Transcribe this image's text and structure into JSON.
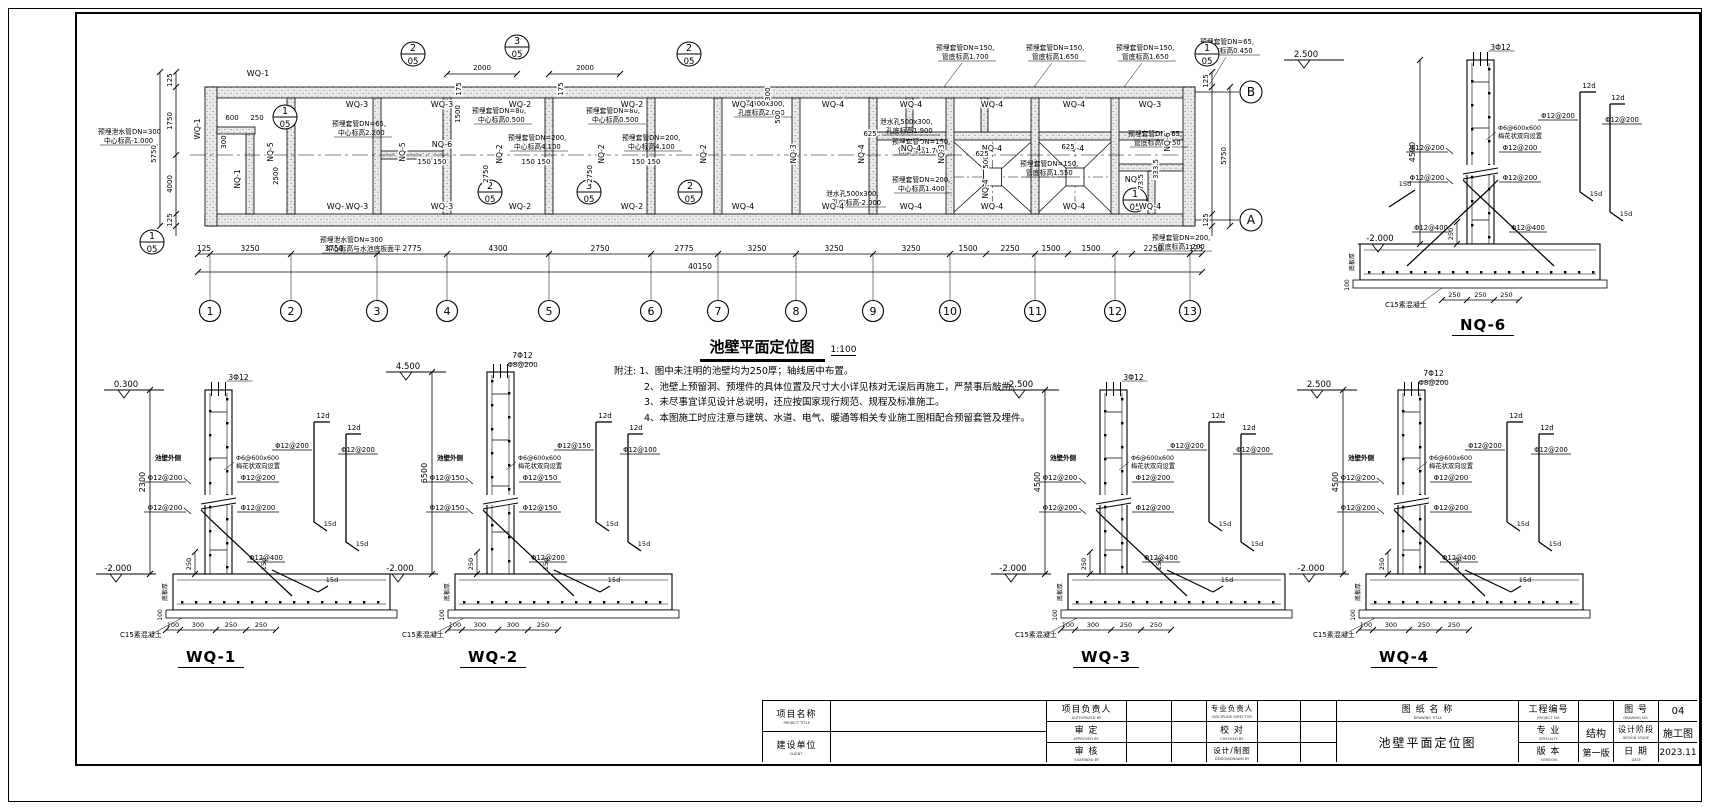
{
  "plan": {
    "title": "池壁平面定位图",
    "scale": "1:100",
    "grid_numbers": [
      "1",
      "2",
      "3",
      "4",
      "5",
      "6",
      "7",
      "8",
      "9",
      "10",
      "11",
      "12",
      "13"
    ],
    "axis_letters": {
      "top": "B",
      "bottom": "A"
    },
    "total_dim": "40150",
    "bottom_dims": [
      {
        "t": "125",
        "x": 124
      },
      {
        "t": "3250",
        "x": 170
      },
      {
        "t": "3750",
        "x": 254
      },
      {
        "t": "2775",
        "x": 332
      },
      {
        "t": "4300",
        "x": 418
      },
      {
        "t": "2750",
        "x": 520
      },
      {
        "t": "2775",
        "x": 604
      },
      {
        "t": "3250",
        "x": 677
      },
      {
        "t": "3250",
        "x": 754
      },
      {
        "t": "3250",
        "x": 831
      },
      {
        "t": "1500",
        "x": 888
      },
      {
        "t": "2250",
        "x": 930
      },
      {
        "t": "1500",
        "x": 971
      },
      {
        "t": "1500",
        "x": 1011
      },
      {
        "t": "2250",
        "x": 1073
      },
      {
        "t": "125",
        "x": 1116
      }
    ],
    "dims": [
      {
        "t": "125",
        "x": 92,
        "y": 66,
        "r": 1
      },
      {
        "t": "1750",
        "x": 92,
        "y": 107,
        "r": 1
      },
      {
        "t": "4000",
        "x": 92,
        "y": 170,
        "r": 1
      },
      {
        "t": "125",
        "x": 92,
        "y": 206,
        "r": 1
      },
      {
        "t": "5750",
        "x": 76,
        "y": 140,
        "r": 1
      },
      {
        "t": "600",
        "x": 152,
        "y": 106
      },
      {
        "t": "250",
        "x": 177,
        "y": 106
      },
      {
        "t": "300",
        "x": 146,
        "y": 128,
        "r": 1
      },
      {
        "t": "2500",
        "x": 198,
        "y": 162,
        "r": 1
      },
      {
        "t": "1500",
        "x": 380,
        "y": 100,
        "r": 1
      },
      {
        "t": "2750",
        "x": 408,
        "y": 160,
        "r": 1
      },
      {
        "t": "2750",
        "x": 512,
        "y": 160,
        "r": 1
      },
      {
        "t": "175",
        "x": 381,
        "y": 75,
        "r": 1
      },
      {
        "t": "175",
        "x": 483,
        "y": 75,
        "r": 1
      },
      {
        "t": "150  150",
        "x": 352,
        "y": 150
      },
      {
        "t": "150  150",
        "x": 456,
        "y": 150
      },
      {
        "t": "150  150",
        "x": 566,
        "y": 150
      },
      {
        "t": "2000",
        "x": 402,
        "y": 56
      },
      {
        "t": "2000",
        "x": 505,
        "y": 56
      },
      {
        "t": "300",
        "x": 690,
        "y": 80,
        "r": 1
      },
      {
        "t": "500",
        "x": 700,
        "y": 103,
        "r": 1
      },
      {
        "t": "500",
        "x": 908,
        "y": 148,
        "r": 1
      },
      {
        "t": "625",
        "x": 790,
        "y": 122
      },
      {
        "t": "625",
        "x": 902,
        "y": 142
      },
      {
        "t": "625",
        "x": 988,
        "y": 135
      },
      {
        "t": "333.5",
        "x": 1078,
        "y": 155,
        "r": 1
      },
      {
        "t": "73.5",
        "x": 1063,
        "y": 168,
        "r": 1
      },
      {
        "t": "125",
        "x": 1128,
        "y": 67,
        "r": 1
      },
      {
        "t": "125",
        "x": 1128,
        "y": 206,
        "r": 1
      },
      {
        "t": "5750",
        "x": 1146,
        "y": 142,
        "r": 1
      }
    ],
    "wall_labels": [
      {
        "t": "WQ-1",
        "x": 178,
        "y": 62
      },
      {
        "t": "WQ-3",
        "x": 277,
        "y": 93
      },
      {
        "t": "WQ-3",
        "x": 362,
        "y": 93
      },
      {
        "t": "WQ-2",
        "x": 440,
        "y": 93
      },
      {
        "t": "WQ-2",
        "x": 552,
        "y": 93
      },
      {
        "t": "WQ-4",
        "x": 663,
        "y": 93
      },
      {
        "t": "WQ-4",
        "x": 753,
        "y": 93
      },
      {
        "t": "WQ-4",
        "x": 831,
        "y": 93
      },
      {
        "t": "WQ-4",
        "x": 912,
        "y": 93
      },
      {
        "t": "WQ-4",
        "x": 994,
        "y": 93
      },
      {
        "t": "WQ-3",
        "x": 1070,
        "y": 93
      },
      {
        "t": "WQ-1",
        "x": 258,
        "y": 195
      },
      {
        "t": "WQ-3",
        "x": 277,
        "y": 195
      },
      {
        "t": "WQ-3",
        "x": 362,
        "y": 195
      },
      {
        "t": "WQ-2",
        "x": 440,
        "y": 195
      },
      {
        "t": "WQ-2",
        "x": 552,
        "y": 195
      },
      {
        "t": "WQ-4",
        "x": 663,
        "y": 195
      },
      {
        "t": "WQ-4",
        "x": 753,
        "y": 195
      },
      {
        "t": "WQ-4",
        "x": 831,
        "y": 195
      },
      {
        "t": "WQ-4",
        "x": 912,
        "y": 195
      },
      {
        "t": "WQ-4",
        "x": 994,
        "y": 195
      },
      {
        "t": "WQ-4",
        "x": 1070,
        "y": 195
      },
      {
        "t": "NQ-4",
        "x": 831,
        "y": 137
      },
      {
        "t": "NQ-4",
        "x": 912,
        "y": 137
      },
      {
        "t": "NQ-4",
        "x": 994,
        "y": 137
      },
      {
        "t": "NQ-6",
        "x": 362,
        "y": 133
      },
      {
        "t": "NQ-6",
        "x": 1055,
        "y": 168
      }
    ],
    "vlabels": [
      {
        "t": "WQ-1",
        "x": 120,
        "y": 115
      },
      {
        "t": "NQ-1",
        "x": 160,
        "y": 165
      },
      {
        "t": "NQ-5",
        "x": 193,
        "y": 138
      },
      {
        "t": "NQ-5",
        "x": 325,
        "y": 138
      },
      {
        "t": "NQ-2",
        "x": 422,
        "y": 140
      },
      {
        "t": "NQ-2",
        "x": 524,
        "y": 140
      },
      {
        "t": "NQ-2",
        "x": 626,
        "y": 140
      },
      {
        "t": "NQ-3",
        "x": 716,
        "y": 140
      },
      {
        "t": "NQ-3",
        "x": 864,
        "y": 140
      },
      {
        "t": "NQ-4",
        "x": 784,
        "y": 140
      },
      {
        "t": "NQ-4",
        "x": 908,
        "y": 175
      },
      {
        "t": "NQ-6",
        "x": 1090,
        "y": 128
      }
    ],
    "annotations": [
      {
        "a": "预埋泄水管DN=300",
        "b": "中心标高-1.000",
        "x": 18,
        "y": 120
      },
      {
        "a": "预埋套管DN=65,",
        "b": "中心标高2.200",
        "x": 252,
        "y": 112
      },
      {
        "a": "预埋套管DN=80,",
        "b": "中心标高0.500",
        "x": 392,
        "y": 99
      },
      {
        "a": "预埋套管DN=80,",
        "b": "中心标高0.500",
        "x": 506,
        "y": 99
      },
      {
        "a": "预埋套管DN=200,",
        "b": "中心标高4.100",
        "x": 428,
        "y": 126
      },
      {
        "a": "预埋套管DN=200,",
        "b": "中心标高4.100",
        "x": 542,
        "y": 126
      },
      {
        "a": "泄水孔500x300,",
        "b": "孔底标高2.000",
        "x": 652,
        "y": 92
      },
      {
        "a": "泄水孔500x300,",
        "b": "孔底标高1.900",
        "x": 800,
        "y": 110
      },
      {
        "a": "预埋套管DN=150,",
        "b": "管底标高1.700",
        "x": 856,
        "y": 36
      },
      {
        "a": "预埋套管DN=150,",
        "b": "管底标高1.650",
        "x": 946,
        "y": 36
      },
      {
        "a": "预埋套管DN=150,",
        "b": "管底标高1.650",
        "x": 1036,
        "y": 36
      },
      {
        "a": "预埋套管DN=65,",
        "b": "管底标高0.450",
        "x": 1120,
        "y": 30
      },
      {
        "a": "预埋套管DN=150,",
        "b": "管底标高1.700",
        "x": 812,
        "y": 130
      },
      {
        "a": "预埋套管DN=65,",
        "b": "管底标高0.450",
        "x": 1048,
        "y": 122
      },
      {
        "a": "预埋套管DN=150,",
        "b": "管底标高1.550",
        "x": 940,
        "y": 152
      },
      {
        "a": "预埋套管DN=200,",
        "b": "中心标高1.400",
        "x": 812,
        "y": 168
      },
      {
        "a": "泄水孔500x300,",
        "b": "孔底标高-2.000",
        "x": 746,
        "y": 182
      },
      {
        "a": "预埋套管DN=200,",
        "b": "管底标高1.200",
        "x": 1072,
        "y": 226
      },
      {
        "a": "预埋泄水管DN=300",
        "b": "中心标高与水池底板面平",
        "x": 240,
        "y": 228
      }
    ],
    "detail_bubbles": [
      {
        "n": "1",
        "d": "05",
        "x": 205,
        "y": 103
      },
      {
        "n": "1",
        "d": "05",
        "x": 72,
        "y": 228
      },
      {
        "n": "2",
        "d": "05",
        "x": 333,
        "y": 40
      },
      {
        "n": "3",
        "d": "05",
        "x": 437,
        "y": 33
      },
      {
        "n": "2",
        "d": "05",
        "x": 609,
        "y": 40
      },
      {
        "n": "2",
        "d": "05",
        "x": 410,
        "y": 178
      },
      {
        "n": "3",
        "d": "05",
        "x": 509,
        "y": 178
      },
      {
        "n": "2",
        "d": "05",
        "x": 610,
        "y": 178
      },
      {
        "n": "1",
        "d": "05",
        "x": 1055,
        "y": 186
      },
      {
        "n": "1",
        "d": "05",
        "x": 1127,
        "y": 40
      }
    ]
  },
  "notes": {
    "prefix": "附注:",
    "lines": [
      "1、图中未注明的池壁均为250厚；轴线居中布置。",
      "2、池壁上预留洞、预埋件的具体位置及尺寸大小详见核对无误后再施工，严禁事后敲凿。",
      "3、未尽事宜详见设计总说明，还应按国家现行规范、规程及标准施工。",
      "4、本图施工时应注意与建筑、水道、电气、暖通等相关专业施工图相配合预留套管及埋件。"
    ]
  },
  "sections": {
    "wq1": {
      "name": "WQ-1",
      "lvl": "0.300",
      "low": "-2.000",
      "height": "2300",
      "top_bars": [
        "3Φ12"
      ],
      "left": [
        "Φ12@200",
        "Φ12@200"
      ],
      "right": [
        "Φ12@200",
        "Φ12@200"
      ],
      "float_labels": [
        "Φ12@200",
        "Φ12@200"
      ],
      "tie": [
        "Φ6@600x600",
        "梅花状双向设置"
      ],
      "diag": "Φ12@400",
      "side": "池壁外侧",
      "slab": "底板厚",
      "c15": "C15素混凝土",
      "d250": "250",
      "d100": "100",
      "hooks": [
        "12d",
        "12d",
        "15d",
        "15d"
      ],
      "bdims": [
        "100",
        "300",
        "250",
        "250"
      ]
    },
    "wq2": {
      "name": "WQ-2",
      "lvl": "4.500",
      "low": "-2.000",
      "height": "6500",
      "top_bars": [
        "7Φ12",
        "Φ8@200"
      ],
      "left": [
        "Φ12@150",
        "Φ12@150"
      ],
      "right": [
        "Φ12@150",
        "Φ12@150"
      ],
      "float_labels": [
        "Φ12@150",
        "Φ12@100"
      ],
      "tie": [
        "Φ6@600x600",
        "梅花状双向设置"
      ],
      "diag": "Φ12@200",
      "side": "池壁外侧",
      "slab": "底板厚",
      "c15": "C15素混凝土",
      "d250": "250",
      "d100": "100",
      "hooks": [
        "12d",
        "12d",
        "15d",
        "15d"
      ],
      "bdims": [
        "100",
        "300",
        "300",
        "250"
      ]
    },
    "wq3": {
      "name": "WQ-3",
      "lvl": "2.500",
      "low": "-2.000",
      "height": "4500",
      "top_bars": [
        "3Φ12"
      ],
      "left": [
        "Φ12@200",
        "Φ12@200"
      ],
      "right": [
        "Φ12@200",
        "Φ12@200"
      ],
      "float_labels": [
        "Φ12@200",
        "Φ12@200"
      ],
      "tie": [
        "Φ6@600x600",
        "梅花状双向设置"
      ],
      "diag": "Φ12@400",
      "side": "池壁外侧",
      "slab": "底板厚",
      "c15": "C15素混凝土",
      "d250": "250",
      "d100": "100",
      "hooks": [
        "12d",
        "12d",
        "15d",
        "15d"
      ],
      "bdims": [
        "100",
        "300",
        "250",
        "250"
      ]
    },
    "wq4": {
      "name": "WQ-4",
      "lvl": "2.500",
      "low": "-2.000",
      "height": "4500",
      "top_bars": [
        "7Φ12",
        "Φ8@200"
      ],
      "left": [
        "Φ12@200",
        "Φ12@200"
      ],
      "right": [
        "Φ12@200",
        "Φ12@200"
      ],
      "float_labels": [
        "Φ12@200",
        "Φ12@200"
      ],
      "tie": [
        "Φ6@600x600",
        "梅花状双向设置"
      ],
      "diag": "Φ12@400",
      "side": "池壁外侧",
      "slab": "底板厚",
      "c15": "C15素混凝土",
      "d250": "250",
      "d100": "100",
      "hooks": [
        "12d",
        "12d",
        "15d",
        "15d"
      ],
      "bdims": [
        "100",
        "300",
        "250",
        "250"
      ]
    },
    "nq6": {
      "name": "NQ-6",
      "lvl": "2.500",
      "low": "-2.000",
      "height": "4500",
      "top_bars": [
        "3Φ12"
      ],
      "left": [
        "Φ12@200",
        "Φ12@200"
      ],
      "right": [
        "Φ12@200",
        "Φ12@200"
      ],
      "float_labels": [
        "Φ12@200",
        "Φ12@200"
      ],
      "tie": [
        "Φ6@600x600",
        "梅花状双向设置"
      ],
      "diag": "Φ12@400",
      "slab": "底板厚",
      "c15": "C15素混凝土",
      "d250": "250",
      "d100": "100",
      "hooks": [
        "12d",
        "12d",
        "15d",
        "15d"
      ],
      "bdims": [
        "250",
        "250",
        "250"
      ]
    }
  },
  "title_block": {
    "project_title": {
      "zh": "项目名称",
      "en": "PROJECT TITLE"
    },
    "client": {
      "zh": "建设单位",
      "en": "CLIENT"
    },
    "project_director": {
      "zh": "项目负责人",
      "en": "AUTHORIZED BY"
    },
    "approved": {
      "zh": "审  定",
      "en": "APPROVED BY"
    },
    "examined": {
      "zh": "审  核",
      "en": "EXAMINED BY"
    },
    "discipline_director": {
      "zh": "专业负责人",
      "en": "DISCIPLINE DIRECTOR"
    },
    "checked": {
      "zh": "校  对",
      "en": "CHECKED BY"
    },
    "designed": {
      "zh": "设计/制图",
      "en": "DESIGN/DRAWN BY"
    },
    "drawing_title_label": {
      "zh": "图 纸 名 称",
      "en": "DRAWING TITLE"
    },
    "drawing_title_value": "池壁平面定位图",
    "project_no": {
      "zh": "工程编号",
      "en": "PROJECT NO.",
      "value": ""
    },
    "drawing_no": {
      "zh": "图  号",
      "en": "DRAWING NO.",
      "value": "04"
    },
    "specialty": {
      "zh": "专  业",
      "en": "SPECIALTY",
      "value": "结构"
    },
    "design_stage": {
      "zh": "设计阶段",
      "en": "DESIGN STAGE",
      "value": "施工图"
    },
    "version": {
      "zh": "版  本",
      "en": "VERSION",
      "value": "第一版"
    },
    "date": {
      "zh": "日  期",
      "en": "DATE",
      "value": "2023.11"
    }
  }
}
